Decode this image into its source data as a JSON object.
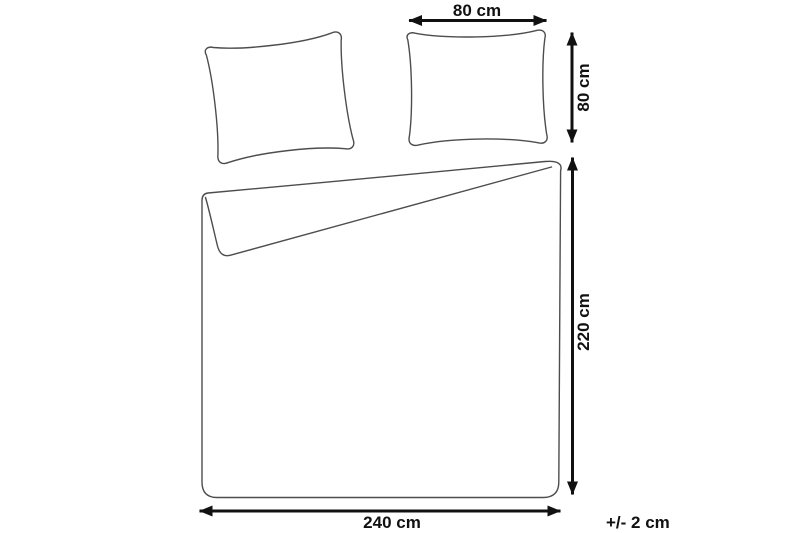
{
  "diagram": {
    "title": "bedding-set-dimensions",
    "colors": {
      "background": "#ffffff",
      "outline": "#4d4d4d",
      "dimension_lines": "#111111",
      "label_text": "#111111"
    },
    "objects": {
      "pillow_left": "pillow outline (tilted)",
      "pillow_right": "pillow outline",
      "duvet_cover": "duvet cover outline with folded-back top corner"
    },
    "labels": {
      "pillow_width": "80 cm",
      "pillow_height": "80 cm",
      "duvet_height": "220 cm",
      "duvet_width": "240 cm",
      "tolerance": "+/- 2 cm"
    },
    "measurements": [
      {
        "target": "pillow",
        "dimension": "width",
        "value": "80 cm"
      },
      {
        "target": "pillow",
        "dimension": "height",
        "value": "80 cm"
      },
      {
        "target": "duvet-cover",
        "dimension": "height",
        "value": "220 cm"
      },
      {
        "target": "duvet-cover",
        "dimension": "width",
        "value": "240 cm"
      },
      {
        "target": "all",
        "dimension": "tolerance",
        "value": "+/- 2 cm"
      }
    ]
  }
}
